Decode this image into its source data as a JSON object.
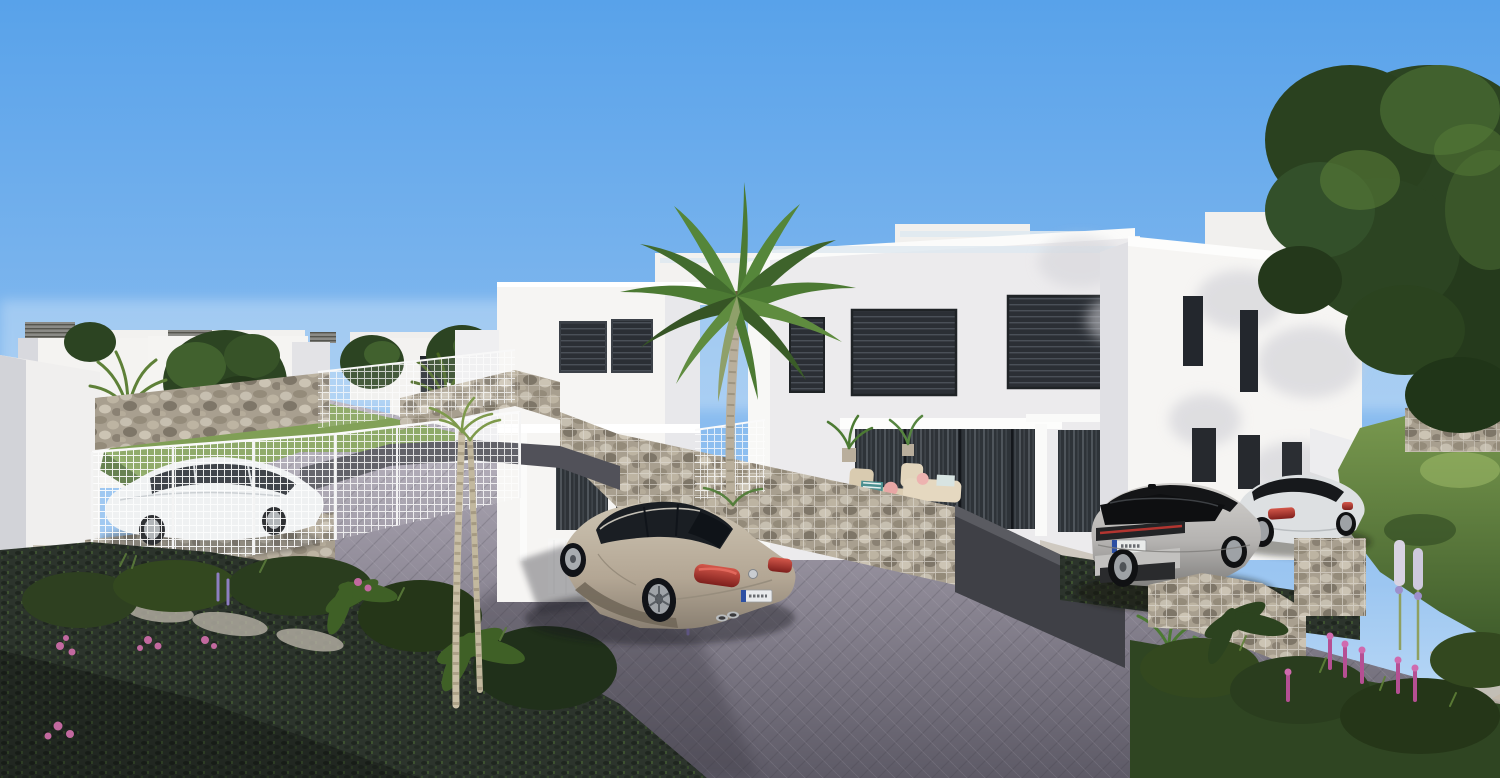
{
  "scene": {
    "title": "3D architectural render of a new-build residential street with white modern villas, parked cars, palm trees, gabion stone walls and a grey block-paved road under a clear blue sky",
    "type": "3d-architectural-visualization",
    "objects": [
      "clear blue sky",
      "rocky hill outcrop between rooflines",
      "white modern two-storey villas with dark louvred windows",
      "rooftop terraces with glass railings",
      "roof ventilation caps",
      "tall palm tree",
      "round garden trees",
      "large dark green trees on the right",
      "white wire-mesh fences",
      "gabion stone walls and stone retaining walls",
      "dark grey retaining walls",
      "grey block-paved road in herringbone pattern",
      "grass-grid paver parking areas",
      "champagne-beige sedan on the road",
      "white hatchback parked behind mesh fence",
      "silver SUV with black roof in driveway",
      "white sports coupe in driveway",
      "terrace lounge furniture with striped and pink cushions",
      "potted palms on terraces",
      "flower beds with pink and lilac blooms",
      "green lawns and shrubs"
    ]
  },
  "colors": {
    "sky_top": "#58A2EA",
    "sky_horizon": "#CBE3F8",
    "wall_white": "#F6F5F3",
    "wall_shaded": "#E6E6E9",
    "wall_dark": "#C9CBD1",
    "window_dark": "#23272D",
    "window_frame": "#3C4148",
    "road_far": "#B7B2BE",
    "road_near": "#5D5A66",
    "stone_light": "#C2BAAB",
    "stone_dark": "#8E897C",
    "mesh_white": "#F4F6F8",
    "grass_sun": "#7FA052",
    "grass_shadow": "#3A512D",
    "paver_dark": "#2C342C",
    "tree_dark": "#2C4422",
    "tree_mid": "#41612E",
    "tree_light": "#5B8039",
    "palm_green": "#4C7A33",
    "car_sedan": "#B3A694",
    "car_white": "#EDEFF1",
    "car_suv": "#B5B3B1",
    "car_suv_roof": "#141517",
    "car_coupe": "#DDE0E2",
    "taillight_red": "#B03028",
    "flower_pink": "#C2699F",
    "flower_lilac": "#9D8FCB",
    "dark_wall": "#3F4046",
    "plate_blue": "#2C4FA3"
  }
}
